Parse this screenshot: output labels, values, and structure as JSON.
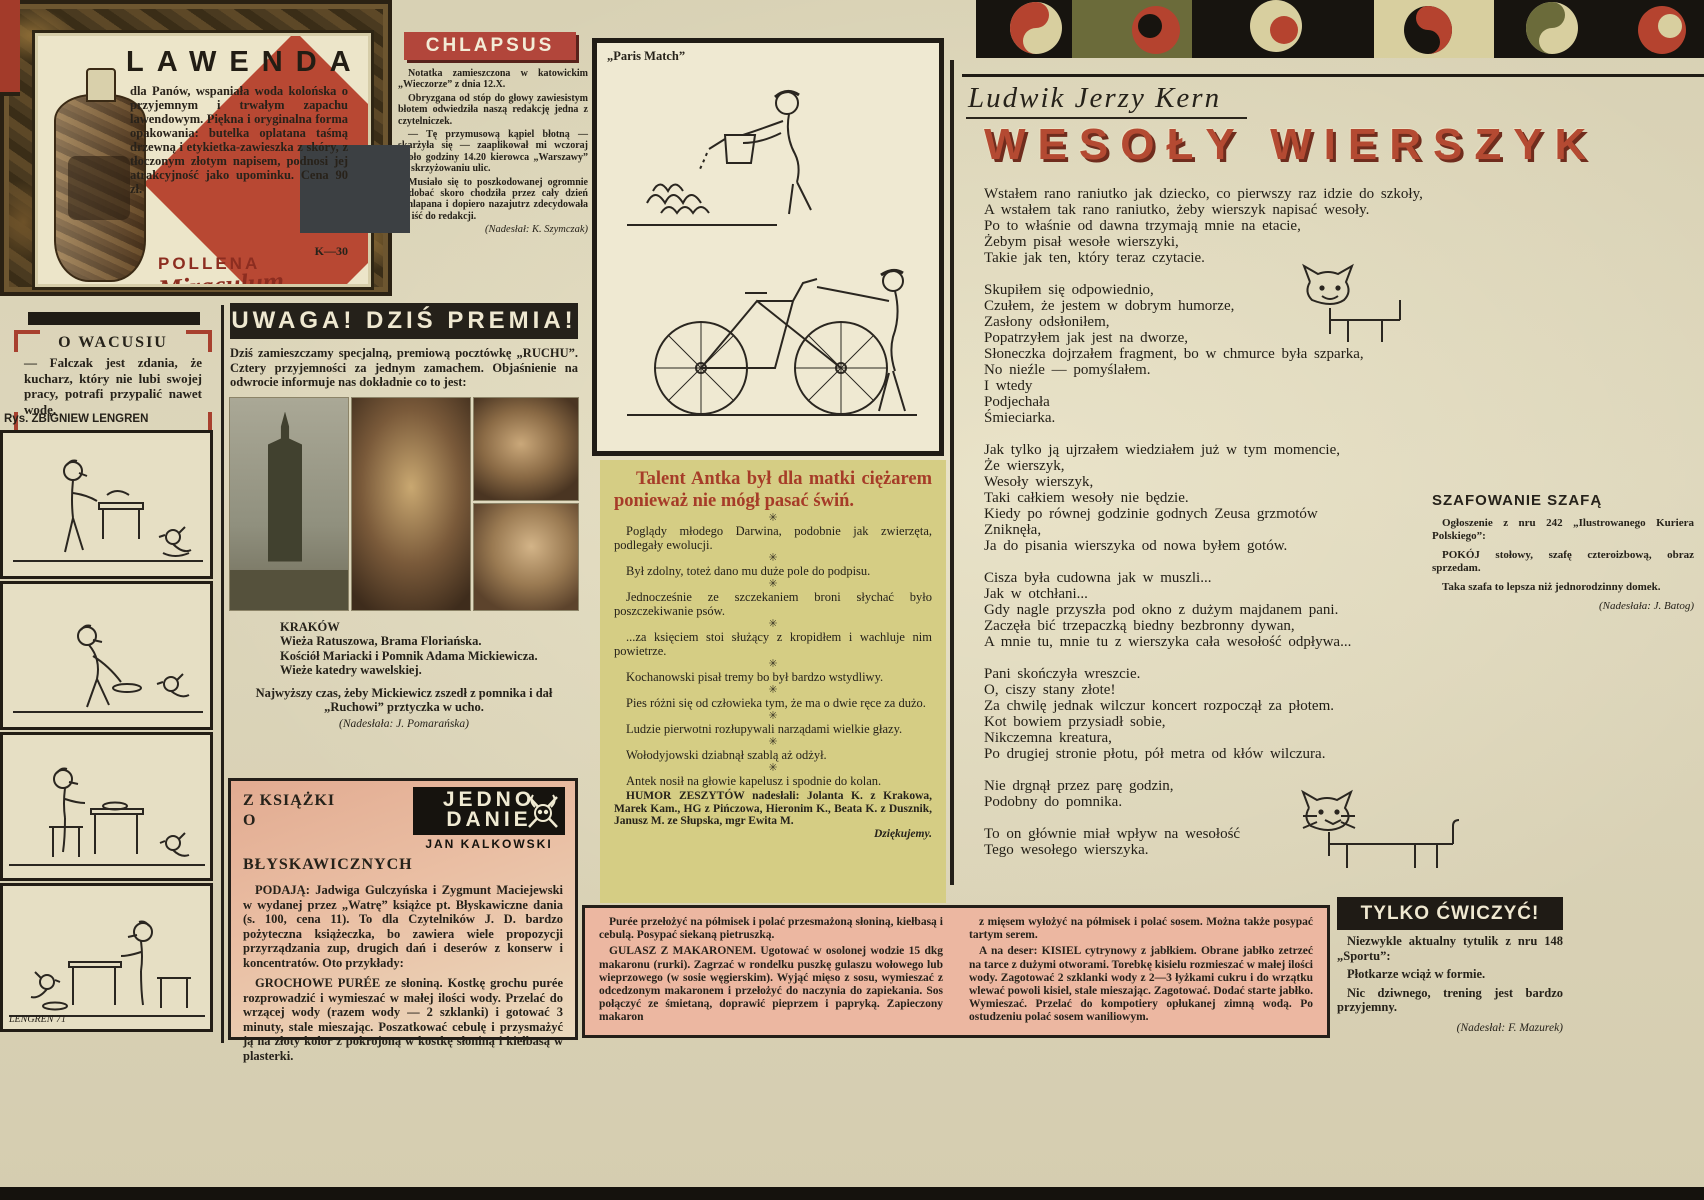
{
  "colors": {
    "paper": "#d9d2b6",
    "ink": "#241f19",
    "accent_red": "#b2463b",
    "humor_bg": "#d5cd84",
    "pink_bg": "#ecb7a1",
    "banner_black": "#25211a",
    "title_red": "#b44a32"
  },
  "lawenda_ad": {
    "title": "LAWENDA",
    "body": "dla Panów, wspaniała woda kolońska o przyjemnym i trwałym zapachu lawendowym. Piękna i oryginalna forma opakowania: butelka oplatana taśmą drzewną i etykietka-zawieszka z skóry, z tłoczonym złotym napisem, podnosi jej atrakcyjność jako upominku. Cena 90 zł.",
    "code": "K—30",
    "brand_top": "POLLENA",
    "brand_script": "Miraculum"
  },
  "chlapsus": {
    "title": "CHLAPSUS",
    "paragraphs": [
      "Notatka zamieszczona w katowickim „Wieczorze” z dnia 12.X.",
      "Obryzgana od stóp do głowy zawiesistym błotem odwiedziła naszą redakcję jedna z czytelniczek.",
      "— Tę przymusową kąpiel błotną — skarżyła się — zaaplikował mi wczoraj około godziny 14.20 kierowca „Warszawy” na skrzyżowaniu ulic.",
      "Musiało się to poszkodowanej ogromnie podobać skoro chodziła przez cały dzień ochlapana i dopiero nazajutrz zdecydowała się iść do redakcji."
    ],
    "credit": "(Nadesłał: K. Szymczak)"
  },
  "paris_match": {
    "label": "„Paris Match”"
  },
  "o_wacusiu": {
    "title": "O WACUSIU",
    "body": "— Falczak jest zdania, że kucharz, który nie lubi swojej pracy, potrafi przypalić nawet wodę."
  },
  "lengren": {
    "credit": "Rys. ZBIGNIEW LENGREN",
    "signature": "LENGREN 71"
  },
  "uwaga": {
    "title": "UWAGA! DZIŚ PREMIA!",
    "intro": "Dziś zamieszczamy specjalną, premiową pocztówkę „RUCHU”. Cztery przyjemności za jednym zamachem. Objaśnienie na odwrocie informuje nas dokładnie co to jest:",
    "caption_lines": [
      "KRAKÓW",
      "Wieża Ratuszowa, Brama Floriańska.",
      "Kościół Mariacki i Pomnik Adama Mickiewicza.",
      "Wieże katedry wawelskiej."
    ],
    "note": "Najwyższy czas, żeby Mickiewicz zszedł z pomnika i dał „Ruchowi” prztyczka w ucho.",
    "credit": "(Nadesłała: J. Pomarańska)"
  },
  "humor": {
    "title": "Talent Antka był dla matki ciężarem ponieważ nie mógł pasać świń.",
    "separator_glyph": "✳",
    "items": [
      "Poglądy młodego Darwina, podobnie jak zwierzęta, podlegały ewolucji.",
      "Był zdolny, toteż dano mu duże pole do podpisu.",
      "Jednocześnie ze szczekaniem broni słychać było poszczekiwanie psów.",
      "...za księciem stoi służący z kropidłem i wachluje nim powietrze.",
      "Kochanowski pisał tremy bo był bardzo wstydliwy.",
      "Pies różni się od człowieka tym, że ma o dwie ręce za dużo.",
      "Ludzie pierwotni rozłupywali narządami wielkie głazy.",
      "Wołodyjowski dziabnął szablą aż odżył.",
      "Antek nosił na głowie kapelusz i spodnie do kolan."
    ],
    "credit": "HUMOR ZESZYTÓW nadesłali: Jolanta K. z Krakowa, Marek Kam., HG z Pińczowa, Hieronim K., Beata K. z Dusznik, Janusz M. ze Słupska, mgr Ewita M.",
    "thanks": "Dziękujemy."
  },
  "poem": {
    "author": "Ludwik Jerzy Kern",
    "title": "WESOŁY WIERSZYK",
    "lines": [
      "Wstałem rano raniutko jak dziecko, co pierwszy raz idzie do szkoły,",
      "A wstałem tak rano raniutko, żeby wierszyk napisać wesoły.",
      "Po to właśnie od dawna trzymają mnie na etacie,",
      "Żebym pisał wesołe wierszyki,",
      "Takie jak ten, który teraz czytacie.",
      "",
      "Skupiłem się odpowiednio,",
      "Czułem, że jestem w dobrym humorze,",
      "Zasłony odsłoniłem,",
      "Popatrzyłem jak jest na dworze,",
      "Słoneczka dojrzałem fragment, bo w chmurce była szparka,",
      "No nieźle — pomyślałem.",
      "I wtedy",
      "Podjechała",
      "Śmieciarka.",
      "",
      "Jak tylko ją ujrzałem wiedziałem już w tym momencie,",
      "Że wierszyk,",
      "Wesoły wierszyk,",
      "Taki całkiem wesoły nie będzie.",
      "Kiedy po równej godzinie godnych Zeusa grzmotów",
      "Zniknęła,",
      "Ja do pisania wierszyka od nowa byłem gotów.",
      "",
      "Cisza była cudowna jak w muszli...",
      "Jak w otchłani...",
      "Gdy nagle przyszła pod okno z dużym majdanem pani.",
      "Zaczęła bić trzepaczką biedny bezbronny dywan,",
      "A mnie tu, mnie tu z wierszyka cała wesołość odpływa...",
      "",
      "Pani skończyła wreszcie.",
      "O, ciszy stany złote!",
      "Za chwilę jednak wilczur koncert rozpoczął za płotem.",
      "Kot bowiem przysiadł sobie,",
      "Nikczemna kreatura,",
      "Po drugiej stronie płotu, pół metra od kłów wilczura.",
      "",
      "Nie drgnął przez parę godzin,",
      "Podobny do pomnika.",
      "",
      "To on głównie miał wpływ na wesołość",
      "Tego wesołego wierszyka."
    ]
  },
  "szafowanie": {
    "title": "SZAFOWANIE SZAFĄ",
    "paragraphs": [
      "Ogłoszenie z nru 242 „Ilustrowanego Kuriera Polskiego”:",
      "POKÓJ stołowy, szafę czteroizbową, obraz sprzedam.",
      "Taka szafa to lepsza niż jednorodzinny domek."
    ],
    "credit": "(Nadesłała: J. Batog)"
  },
  "z_ksiazki": {
    "heading_line1": "Z KSIĄŻKI",
    "heading_line2": "O BŁYSKAWICZNYCH",
    "logo_line1": "JEDNO",
    "logo_line2": "DANIE",
    "logo_author": "JAN KALKOWSKI",
    "paragraphs": [
      "PODAJĄ: Jadwiga Gulczyńska i Zygmunt Maciejewski w wydanej przez „Watrę” książce pt. Błyskawiczne dania (s. 100, cena 11). To dla Czytelników J. D. bardzo pożyteczna książeczka, bo zawiera wiele propozycji przyrządzania zup, drugich dań i deserów z konserw i koncentratów. Oto przykłady:",
      "GROCHOWE PURÉE ze słoniną. Kostkę grochu purée rozprowadzić i wymieszać w małej ilości wody. Przelać do wrzącej wody (razem wody — 2 szklanki) i gotować 3 minuty, stale mieszając. Poszatkować cebulę i przysmażyć ją na złoty kolor z pokrojoną w kostkę słoniną i kiełbasą w plasterki."
    ]
  },
  "recipes": {
    "left": [
      "Purée przełożyć na półmisek i polać przesmażoną słoniną, kiełbasą i cebulą. Posypać siekaną pietruszką.",
      "GULASZ Z MAKARONEM. Ugotować w osolonej wodzie 15 dkg makaronu (rurki). Zagrzać w rondelku puszkę gulaszu wołowego lub wieprzowego (w sosie węgierskim). Wyjąć mięso z sosu, wymieszać z odcedzonym makaronem i przełożyć do naczynia do zapiekania. Sos połączyć ze śmietaną, doprawić pieprzem i papryką. Zapieczony makaron"
    ],
    "right": [
      "z mięsem wyłożyć na półmisek i polać sosem. Można także posypać tartym serem.",
      "A na deser: KISIEL cytrynowy z jabłkiem. Obrane jabłko zetrzeć na tarce z dużymi otworami. Torebkę kisielu rozmieszać w małej ilości wody. Zagotować 2 szklanki wody z 2—3 łyżkami cukru i do wrzątku wlewać powoli kisiel, stale mieszając. Zagotować. Dodać starte jabłko. Wymieszać. Przelać do kompotiery opłukanej zimną wodą. Po ostudzeniu polać sosem waniliowym."
    ]
  },
  "tylko_cwiczyc": {
    "title": "TYLKO ĆWICZYĆ!",
    "paragraphs": [
      "Niezwykle aktualny tytulik z nru 148 „Sportu”:",
      "Płotkarze wciąż w formie.",
      "Nic dziwnego, trening jest bardzo przyjemny."
    ],
    "credit": "(Nadesłał: F. Mazurek)"
  }
}
